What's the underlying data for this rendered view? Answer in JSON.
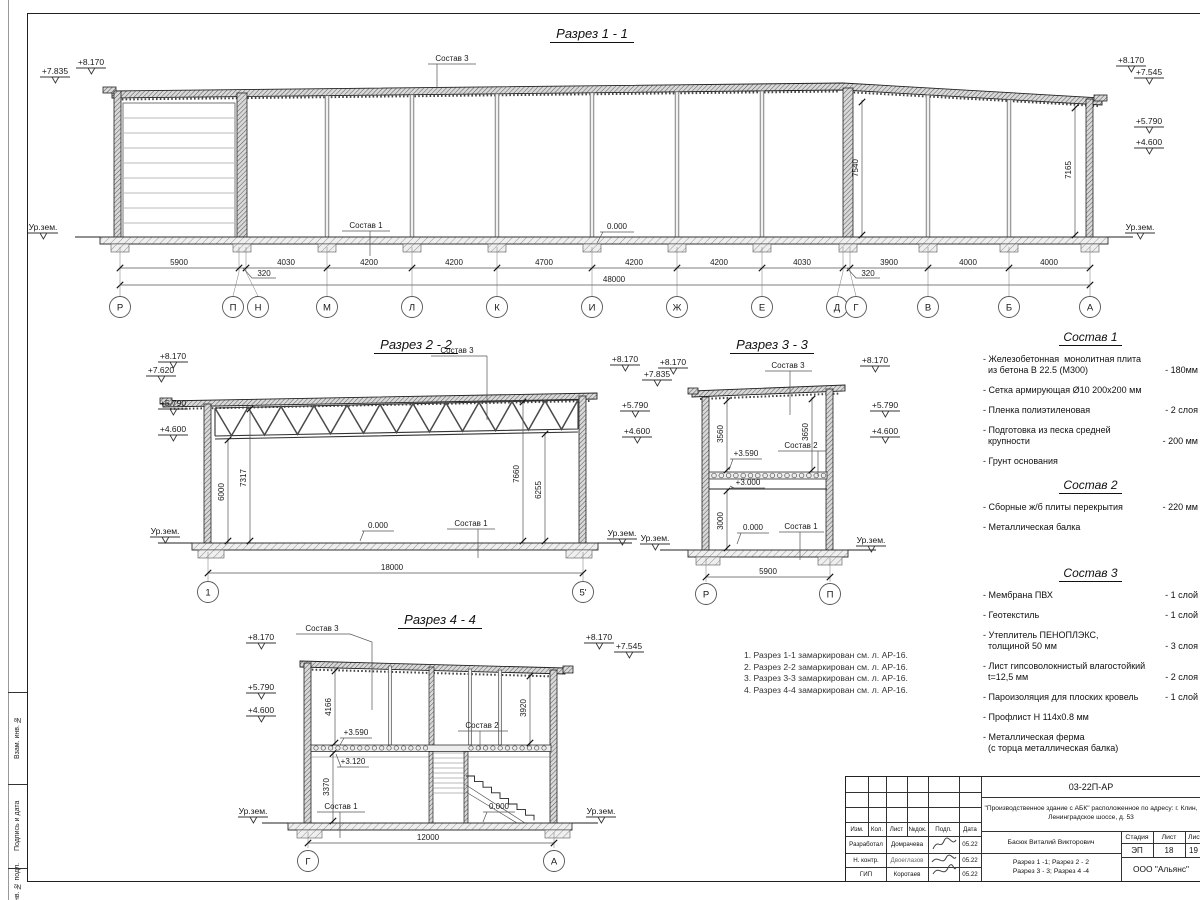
{
  "s1": {
    "title": "Разрез 1 - 1",
    "elev": {
      "l1": "+7.835",
      "l2": "+8.170",
      "r1": "+8.170",
      "r2": "+7.545",
      "r3": "+5.790",
      "r4": "+4.600"
    },
    "ground_l": "Ур.зем.",
    "ground_r": "Ур.зем.",
    "sostav3": "Состав 3",
    "sostav1": "Состав 1",
    "zero": "0.000",
    "vdim1": "7540",
    "vdim2": "7165",
    "dims": [
      "5900",
      "4030",
      "4200",
      "4200",
      "4700",
      "4200",
      "4200",
      "4030",
      "3900",
      "4000",
      "4000"
    ],
    "dim320a": "320",
    "dim320b": "320",
    "total": "48000",
    "axes": [
      "Р",
      "П",
      "Н",
      "М",
      "Л",
      "К",
      "И",
      "Ж",
      "Е",
      "Д",
      "Г",
      "В",
      "Б",
      "А"
    ]
  },
  "s2": {
    "title": "Разрез 2 - 2",
    "elev": {
      "l1": "+8.170",
      "l2": "+7.620",
      "l3": "+5.790",
      "l4": "+4.600",
      "r1": "+8.170",
      "r2": "+5.790",
      "r3": "+4.600"
    },
    "ground_l": "Ур.зем.",
    "ground_r": "Ур.зем.",
    "sostav3": "Состав 3",
    "sostav1": "Состав 1",
    "zero": "0.000",
    "vdims": [
      "6000",
      "7317",
      "7660",
      "6255"
    ],
    "total": "18000",
    "axes": [
      "1",
      "5'"
    ]
  },
  "s3": {
    "title": "Разрез 3 - 3",
    "elev": {
      "l1": "+8.170",
      "l2": "+7.835",
      "r1": "+8.170",
      "r2": "+5.790",
      "r3": "+4.600"
    },
    "ground_l": "Ур.зем.",
    "ground_r": "Ур.зем.",
    "sostav3": "Состав 3",
    "sostav2": "Состав 2",
    "sostav1": "Состав 1",
    "lvl359": "+3.590",
    "lvl300": "+3.000",
    "zero": "0.000",
    "vdims": [
      "3560",
      "3650",
      "3000"
    ],
    "total": "5900",
    "axes": [
      "Р",
      "П"
    ]
  },
  "s4": {
    "title": "Разрез 4 - 4",
    "elev": {
      "l1": "+8.170",
      "l2": "+5.790",
      "l3": "+4.600",
      "r1": "+8.170",
      "r2": "+7.545"
    },
    "ground_l": "Ур.зем.",
    "ground_r": "Ур.зем.",
    "sostav3": "Состав 3",
    "sostav2": "Состав 2",
    "sostav1": "Состав 1",
    "lvl359": "+3.590",
    "lvl312": "+3.120",
    "zero": "0.000",
    "vdims": [
      "4166",
      "3920",
      "3370"
    ],
    "total": "12000",
    "axes": [
      "Г",
      "А"
    ]
  },
  "notes": {
    "n1": "1. Разрез 1-1 замаркирован см. л. АР-16.",
    "n2": "2. Разрез 2-2 замаркирован см. л. АР-16.",
    "n3": "3. Разрез 3-3 замаркирован см. л. АР-16.",
    "n4": "4. Разрез 4-4 замаркирован см. л. АР-16."
  },
  "comp1": {
    "title": "Состав 1",
    "i1t": "- Железобетонная  монолитная плита\n  из бетона В 22.5 (М300)",
    "i1v": "- 180мм",
    "i2t": "- Сетка армирующая Ø10 200х200 мм",
    "i2v": "",
    "i3t": "- Пленка полиэтиленовая",
    "i3v": "- 2 слоя",
    "i4t": "- Подготовка из песка средней\n  крупности",
    "i4v": "- 200 мм",
    "i5t": "- Грунт основания",
    "i5v": ""
  },
  "comp2": {
    "title": "Состав 2",
    "i1t": "- Сборные ж/б плиты перекрытия",
    "i1v": "- 220 мм",
    "i2t": "- Металлическая балка",
    "i2v": ""
  },
  "comp3": {
    "title": "Состав 3",
    "i1t": "- Мембрана ПВХ",
    "i1v": "- 1 слой",
    "i2t": "- Геотекстиль",
    "i2v": "- 1 слой",
    "i3t": "- Утеплитель ПЕНОПЛЭКС,\n  толщиной 50 мм",
    "i3v": "- 3 слоя",
    "i4t": "- Лист гипсоволокнистый влагостойкий\n  t=12,5 мм",
    "i4v": "- 2 слоя",
    "i5t": "- Пароизоляция для плоских кровель",
    "i5v": "- 1 слой",
    "i6t": "- Профлист Н 114х0.8 мм",
    "i6v": "",
    "i7t": "- Металлическая ферма\n  (с торца металлическая балка)",
    "i7v": ""
  },
  "sidestrip": {
    "b1": "Взам. инв. №",
    "b2": "Подпись  и  дата",
    "b3": "Инв. № подл."
  },
  "tb": {
    "doc_number": "03-22П-АР",
    "project": "\"Производственное здание с АБК\" расположенное по адресу: г. Клин, Ленинградское шоссе, д. 53",
    "h_izm": "Изм.",
    "h_kol": "Кол.",
    "h_list": "Лист",
    "h_ndok": "№док.",
    "h_podp": "Подп.",
    "h_data": "Дата",
    "r1_role": "Разработал",
    "r1_name": "Домрачева",
    "r1_date": "05.22",
    "r2_role": "Н. контр.",
    "r2_name": "Двоеглазов",
    "r2_date": "05.22",
    "r3_role": "ГИП",
    "r3_name": "Коротаев",
    "r3_date": "05.22",
    "person": "Басюк Виталий Викторович",
    "sheet_title_1": "Разрез 1 -1;  Разрез 2 - 2",
    "sheet_title_2": "Разрез 3 - 3;  Разрез 4 -4",
    "stage_label": "Стадия",
    "list_label": "Лист",
    "lists_label": "Лист",
    "stage": "ЭП",
    "sheet_no": "18",
    "sheets_total": "19",
    "company": "ООО \"Альянс\""
  }
}
